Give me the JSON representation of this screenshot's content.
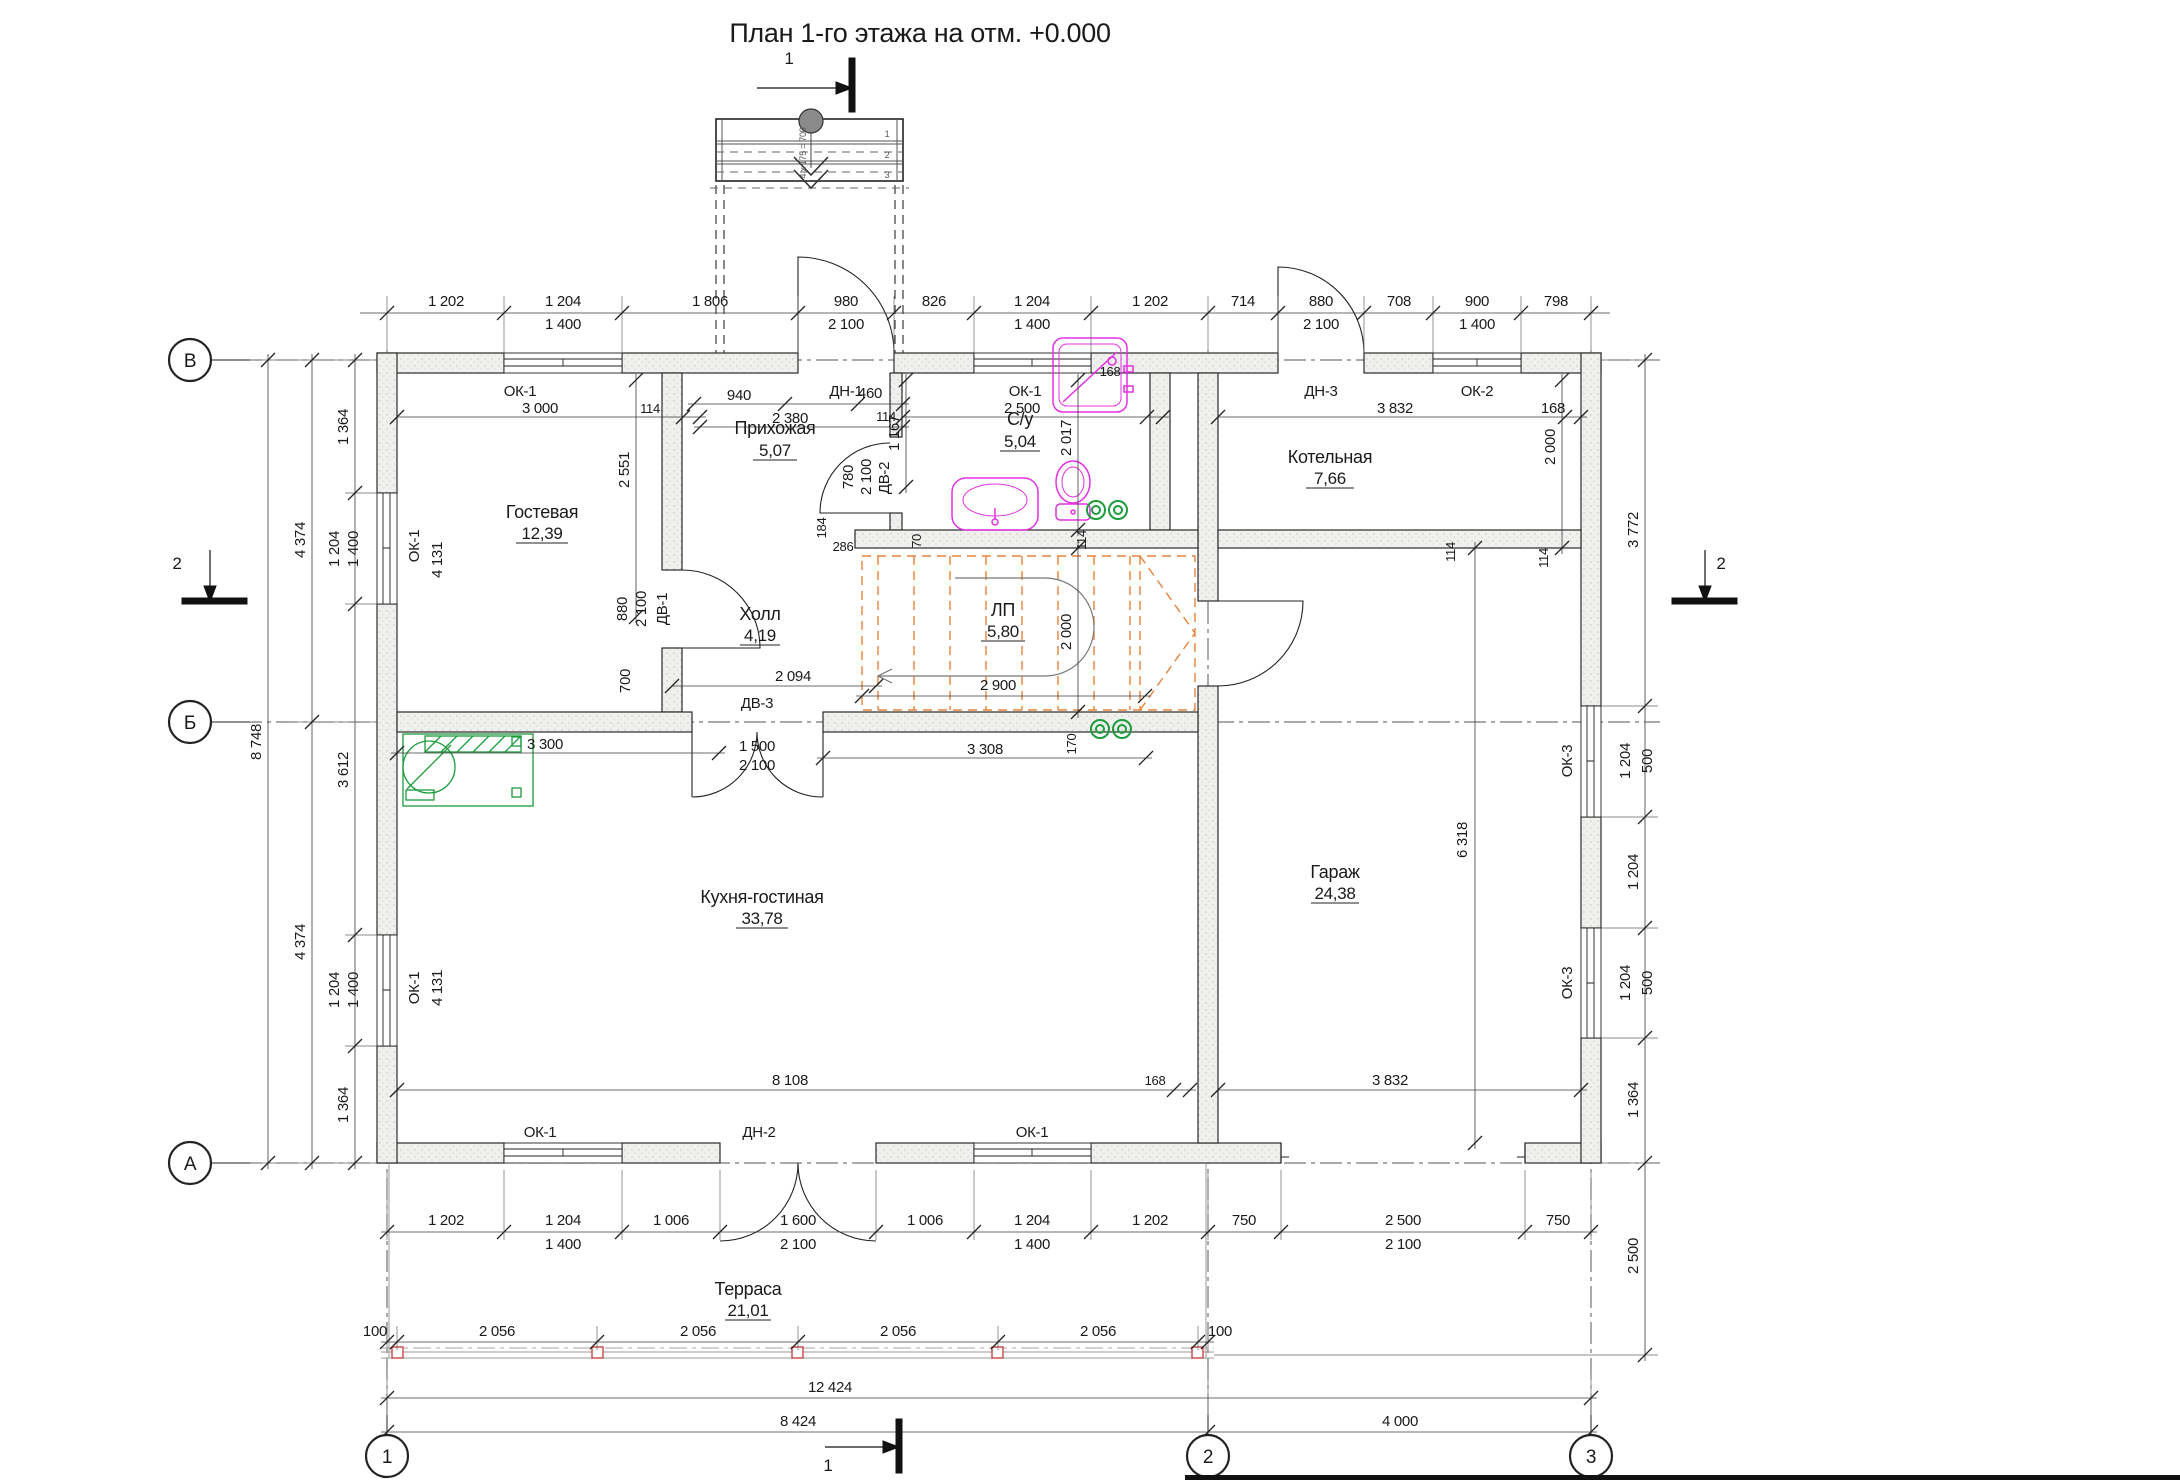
{
  "title": "План 1-го этажа на отм. +0.000",
  "axes": {
    "rows": [
      "В",
      "Б",
      "А"
    ],
    "cols": [
      "1",
      "2",
      "3"
    ]
  },
  "sections": {
    "cut1": "1",
    "cut2": "2"
  },
  "rooms": [
    {
      "name": "Гостевая",
      "area": "12,39"
    },
    {
      "name": "Прихожая",
      "area": "5,07"
    },
    {
      "name": "С/у",
      "area": "5,04"
    },
    {
      "name": "Котельная",
      "area": "7,66"
    },
    {
      "name": "Холл",
      "area": "4,19"
    },
    {
      "name": "ЛП",
      "area": "5,80"
    },
    {
      "name": "Кухня-гостиная",
      "area": "33,78"
    },
    {
      "name": "Гараж",
      "area": "24,38"
    },
    {
      "name": "Терраса",
      "area": "21,01"
    }
  ],
  "openings": {
    "ok1": "ОК-1",
    "ok2": "ОК-2",
    "ok3": "ОК-3",
    "dn1": "ДН-1",
    "dn2": "ДН-2",
    "dn3": "ДН-3",
    "dv1": "ДВ-1",
    "dv2": "ДВ-2",
    "dv3": "ДВ-3"
  },
  "porch": {
    "steps": [
      "1",
      "2",
      "3"
    ],
    "note": "4 х 175 = 700"
  },
  "dims": {
    "top_outer": [
      "1 202",
      "1 204",
      "1 400",
      "1 806",
      "980",
      "2 100",
      "826",
      "1 204",
      "1 400",
      "1 202",
      "714",
      "880",
      "2 100",
      "708",
      "900",
      "1 400",
      "798"
    ],
    "top_inner": [
      "3 000",
      "114",
      "940",
      "2 380",
      "460",
      "114",
      "2 500",
      "168",
      "3 832",
      "168",
      "1 167",
      "2 551",
      "2 017",
      "2 000",
      "114",
      "3 772"
    ],
    "left_outer": [
      "4 374",
      "8 748",
      "4 374"
    ],
    "left_inner": [
      "1 364",
      "1 204",
      "1 400",
      "3 612",
      "1 204",
      "1 400",
      "1 364"
    ],
    "left_room": [
      "4 131",
      "4 131"
    ],
    "right_inner": [
      "1 204",
      "500",
      "1 204",
      "1 204",
      "500",
      "1 364",
      "2 500",
      "6 318",
      "114"
    ],
    "mid": [
      "880",
      "2 100",
      "700",
      "2 094",
      "1 500",
      "2 100",
      "3 300",
      "3 308",
      "170",
      "286",
      "70",
      "184",
      "780",
      "2 100",
      "2 900",
      "2 000",
      "114"
    ],
    "bottom_inner": [
      "8 108",
      "168",
      "3 832"
    ],
    "bottom_outer": [
      "1 202",
      "1 204",
      "1 400",
      "1 006",
      "1 600",
      "2 100",
      "1 006",
      "1 204",
      "1 400",
      "1 202",
      "750",
      "2 500",
      "2 100",
      "750"
    ],
    "terrace_row": [
      "100",
      "2 056",
      "2 056",
      "2 056",
      "2 056",
      "100"
    ],
    "totals": [
      "12 424",
      "8 424",
      "4 000"
    ]
  },
  "colors": {
    "walls": "#2a2a2a",
    "dims": "#3c3c3c",
    "sanitary": "#e331e3",
    "green": "#1c9c3c",
    "stairs": "#e8833a",
    "posts": "#cc4444"
  }
}
